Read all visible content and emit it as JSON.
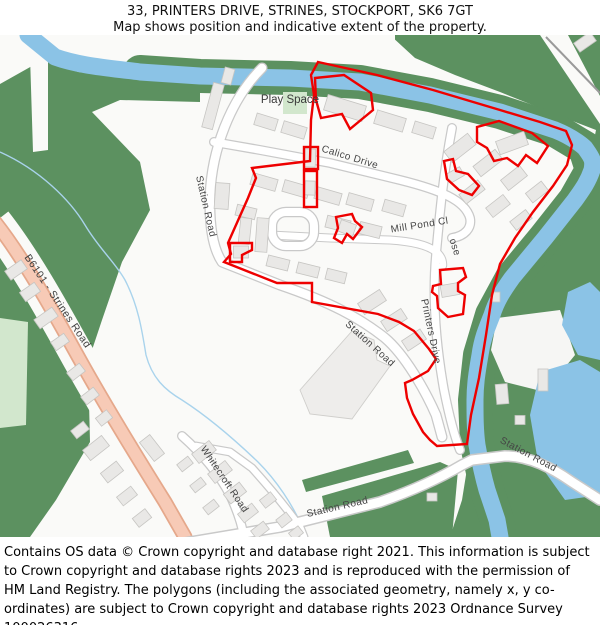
{
  "title": {
    "line1": "33, PRINTERS DRIVE, STRINES, STOCKPORT, SK6 7GT",
    "line2": "Map shows position and indicative extent of the property."
  },
  "map": {
    "area_labels": {
      "play_space": "Play Space"
    },
    "road_labels": {
      "b6101_strines_road": "B6101 - Strines Road",
      "station_road": "Station Road",
      "calico_drive": "Calico Drive",
      "mill_pond_close_part1": "Mill Pond Cl",
      "mill_pond_close_part2": "ose",
      "printers_drive": "Printers Drive",
      "whitecroft_road": "Whitecroft Road"
    },
    "colors": {
      "property_boundary": "#ee0000",
      "water": "#8bc3e6",
      "woodland": "#5c9160",
      "open_green": "#d2e7cd",
      "primary_road_fill": "#f7cab6",
      "primary_road_casing": "#e5a88b",
      "road_casing": "#c9c9c9",
      "building": "#e9e8e6",
      "land": "#fafaf8"
    }
  },
  "footer": {
    "text": "Contains OS data © Crown copyright and database right 2021. This information is subject to Crown copyright and database rights 2023 and is reproduced with the permission of HM Land Registry. The polygons (including the associated geometry, namely x, y co-ordinates) are subject to Crown copyright and database rights 2023 Ordnance Survey 100026316."
  }
}
